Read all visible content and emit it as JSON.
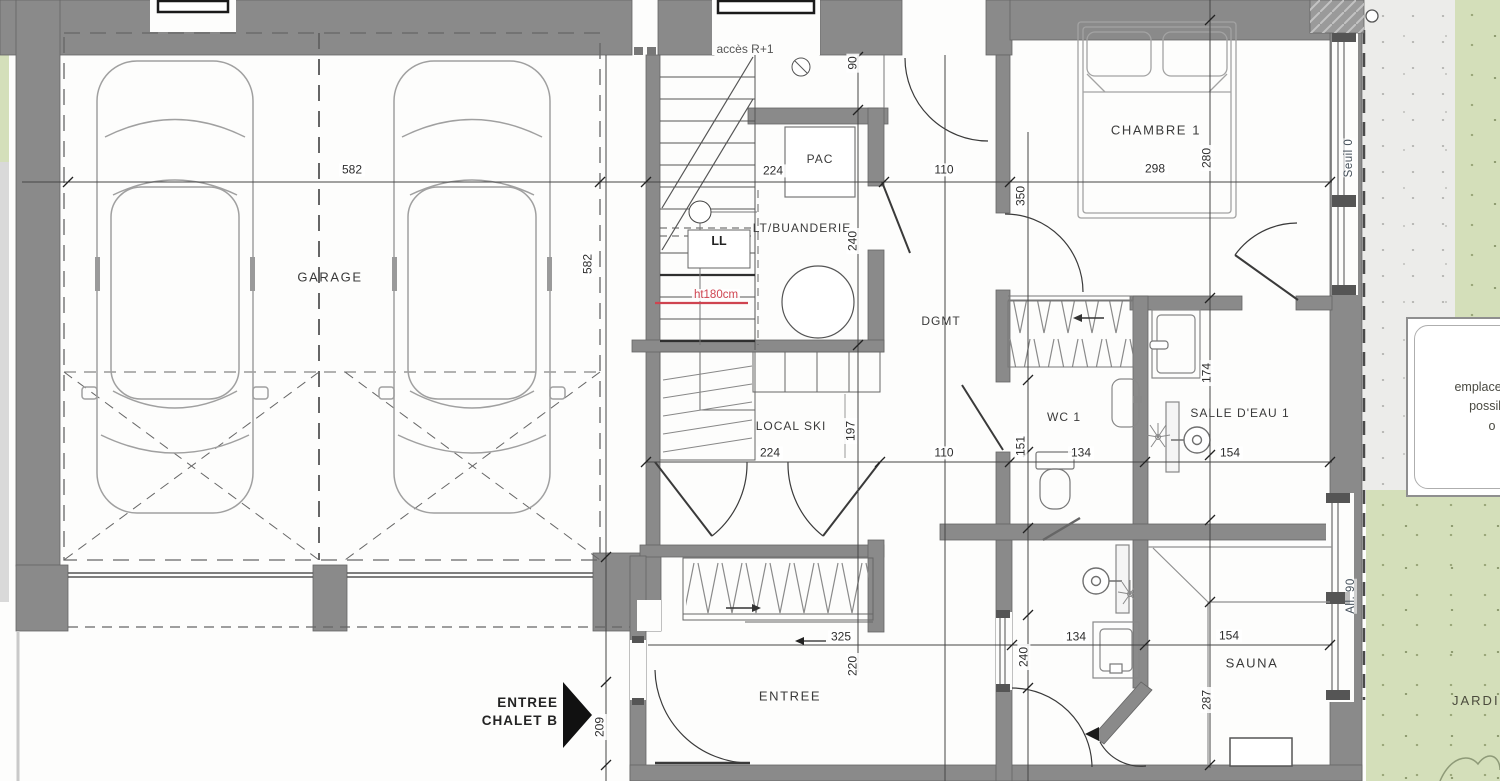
{
  "rooms": {
    "garage": "GARAGE",
    "local_ski": "LOCAL SKI",
    "buanderie": "LT/BUANDERIE",
    "pac": "PAC",
    "dgmt": "DGMT",
    "chambre1": "CHAMBRE 1",
    "wc1": "WC 1",
    "salle_eau1": "SALLE D'EAU 1",
    "entree": "ENTREE",
    "sauna": "SAUNA",
    "jardin": "JARDIN"
  },
  "annotations": {
    "acces_r1": "accès R+1",
    "washer": "LL",
    "height_note": "ht180cm",
    "seuil": "Seuil 0",
    "allege": "All. 90",
    "entrance_arrow_line1": "ENTREE",
    "entrance_arrow_line2": "CHALET B",
    "emplacement_line1": "emplacement",
    "emplacement_line2": "possible",
    "emplacement_line3": "o"
  },
  "dimensions": {
    "garage_width": "582",
    "garage_depth": "582",
    "buanderie_width": "224",
    "buanderie_depth": "240",
    "stair_top": "90",
    "hall_top": "110",
    "chambre_width": "298",
    "chambre_depth": "280",
    "chambre_wall": "350",
    "local_ski_width": "224",
    "local_ski_depth": "197",
    "hall_mid": "110",
    "wc_width": "134",
    "wc_return": "151",
    "salle_eau_width": "154",
    "salle_eau_depth": "174",
    "hall_entry": "325",
    "entry_depth": "220",
    "shower_width": "134",
    "shower_depth": "240",
    "sauna_width": "154",
    "sauna_depth": "287",
    "entry_offset": "209"
  },
  "colors": {
    "wall": "#8a8a8a",
    "garden": "#d4dfba",
    "concrete": "#ececea",
    "note_red": "#cf4450",
    "line": "#3f3f3f"
  }
}
